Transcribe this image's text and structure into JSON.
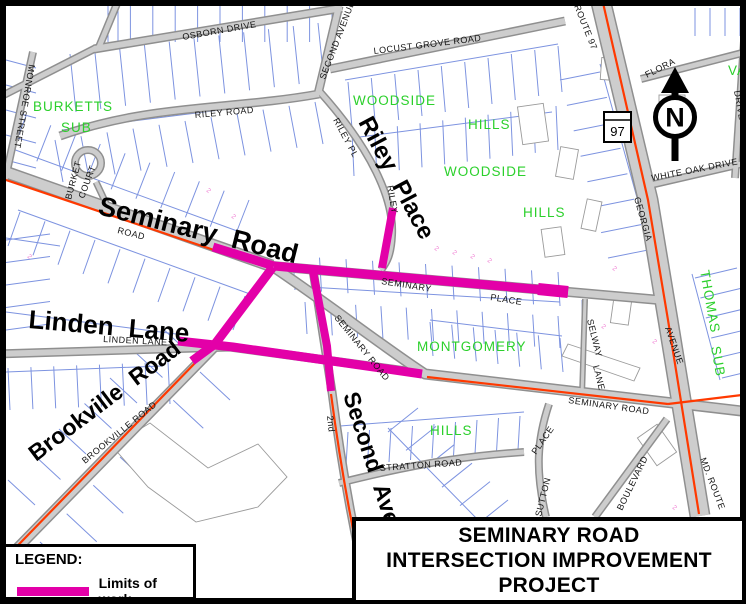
{
  "map": {
    "big_labels": {
      "seminary_road": "Seminary Road",
      "linden_lane": "Linden Lane",
      "brookville_road": "Brookville Road",
      "riley_place": "Riley Place",
      "second_ave": "Second Ave"
    },
    "road_labels": {
      "osborn_drive": "OSBORN DRIVE",
      "second_avenue": "SECOND AVENUE",
      "locust_grove_road": "LOCUST GROVE ROAD",
      "riley_road": "RILEY ROAD",
      "riley_pl": "RILEY PL",
      "riley": "RILEY",
      "monroe_street": "MONROE STREET",
      "burket": "BURKET",
      "court": "COURT",
      "seminary_road_small": "ROAD",
      "linden_lane": "LINDEN LANE",
      "brookville_road": "BROOKVILLE ROAD",
      "second_2nd": "2nd",
      "seminary_road_center": "SEMINARY ROAD",
      "seminary_place_1": "SEMINARY",
      "seminary_place_2": "PLACE",
      "seminary_road_east": "SEMINARY ROAD",
      "stratton_road": "STRATTON ROAD",
      "place": "PLACE",
      "sutton": "SUTTON",
      "boulevard": "BOULEVARD",
      "selway": "SELWAY",
      "lane": "LANE",
      "avenue": "AVENUE",
      "georgia": "GEORGIA",
      "route_97": "ROUTE 97",
      "flora": "FLORA",
      "drive": "DRIVE",
      "white_oak_drive": "WHITE OAK DRIVE",
      "md_route": "MD. ROUTE"
    },
    "subdivisions": {
      "burketts": "BURKETTS",
      "burketts_sub": "SUB",
      "woodside_1": "WOODSIDE",
      "hills_1": "HILLS",
      "woodside_2": "WOODSIDE",
      "hills_2": "HILLS",
      "montgomery": "MONTGOMERY",
      "hills_3": "HILLS",
      "thomas": "THOMAS",
      "thomas_sub": "SUB",
      "va": "VA"
    },
    "route_shield": "97",
    "north_arrow_letter": "N",
    "lot_mark": "2"
  },
  "legend": {
    "title": "LEGEND:",
    "limits_label": "Limits of work"
  },
  "title_block": {
    "line1": "SEMINARY ROAD",
    "line2": "INTERSECTION IMPROVEMENT",
    "line3": "PROJECT"
  },
  "colors": {
    "limits_of_work": "#E300A8",
    "route_highlight": "#FF3900",
    "subdivision_green": "#2BD02B",
    "parcel_blue": "#7D93E0",
    "road_fill": "#CDCDCD",
    "road_casing": "#8F8F8F"
  }
}
